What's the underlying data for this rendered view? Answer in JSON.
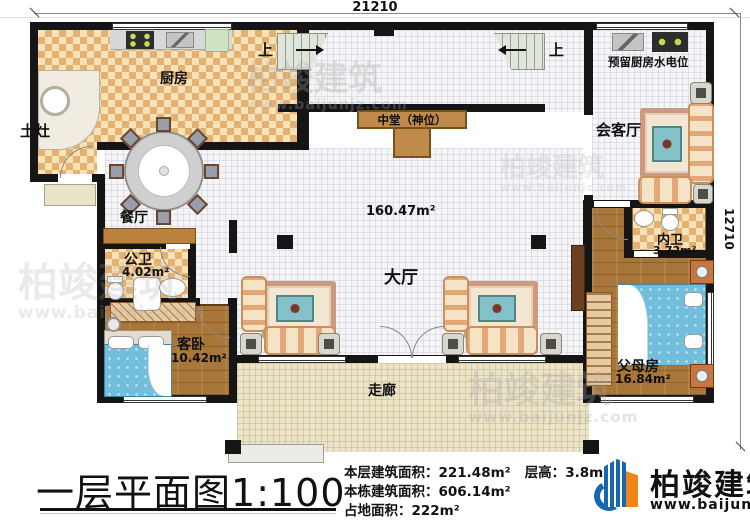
{
  "dimensions": {
    "width": "21210",
    "height": "12710"
  },
  "rooms": {
    "kitchen": {
      "label": "厨房"
    },
    "earthen_stove": {
      "label": "土灶"
    },
    "dining": {
      "label": "餐厅"
    },
    "public_bath": {
      "label": "公卫",
      "area": "4.02m²"
    },
    "guest_bedroom": {
      "label": "客卧",
      "area": "10.42m²"
    },
    "shrine": {
      "label": "中堂（神位）"
    },
    "main_hall": {
      "label": "大厅",
      "area": "160.47m²"
    },
    "reception": {
      "label": "会客厅"
    },
    "reserved_utility": {
      "label": "预留厨房水电位"
    },
    "inner_bath": {
      "label": "内卫",
      "area": "3.72m²"
    },
    "parents_room": {
      "label": "父母房",
      "area": "16.84m²"
    },
    "corridor": {
      "label": "走廊"
    },
    "stair_left": {
      "label": "上"
    },
    "stair_right": {
      "label": "上"
    }
  },
  "title_block": {
    "title": "一层平面图",
    "scale": "1:100",
    "stats": {
      "floor_area_label": "本层建筑面积：",
      "floor_area_value": "221.48m²",
      "height_label": "层高：",
      "height_value": "3.8m",
      "building_area_label": "本栋建筑面积：",
      "building_area_value": "606.14m²",
      "footprint_label": "占地面积：",
      "footprint_value": "222m²"
    }
  },
  "brand": {
    "name": "柏竣建筑",
    "url": "www.baijunjz.com"
  },
  "colors": {
    "wall": "#151515",
    "brand_blue": "#1767b0",
    "brand_orange": "#f08419",
    "bed_blue": "#72bedd",
    "wood": "#a87638"
  }
}
